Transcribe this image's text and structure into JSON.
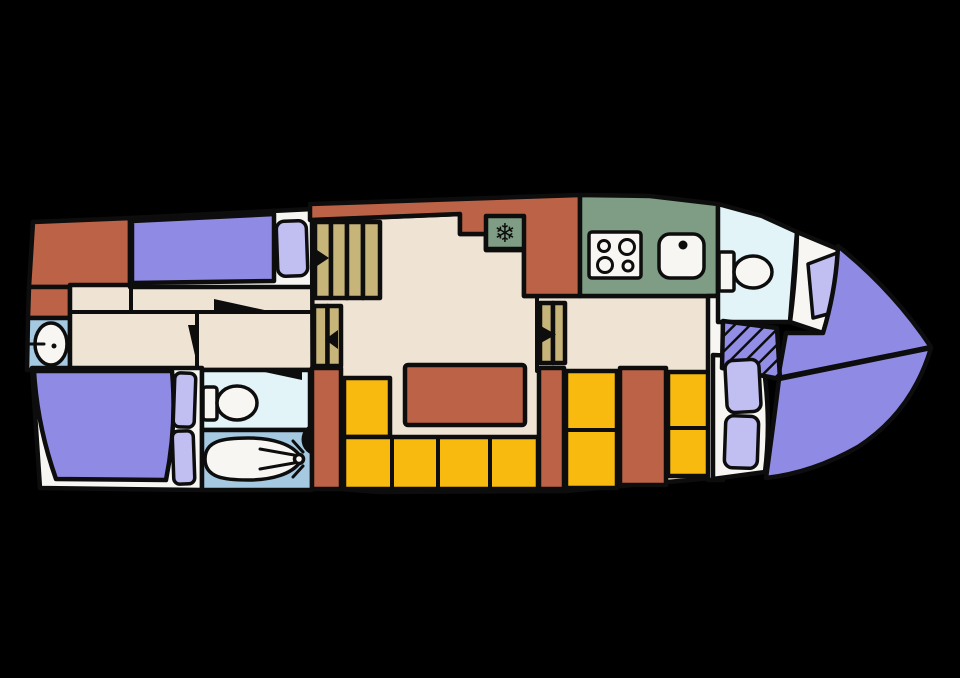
{
  "colors": {
    "hull": "#000000",
    "floor": "#EFE3D4",
    "cabinet": "#BC6347",
    "mattress": "#8F8BE4",
    "pillow": "#C1BEF2",
    "wash_blue": "#A5C9E1",
    "wc_cyan": "#E2F4F8",
    "kitchen_green": "#7F9C85",
    "step_tan": "#C7B478",
    "seat_yellow": "#F9BA10",
    "fixture_white": "#F7F6F2",
    "outline": "#0D0D0D",
    "hatch_purple": "#928EE6"
  },
  "icons": {
    "snowflake": "❄"
  }
}
